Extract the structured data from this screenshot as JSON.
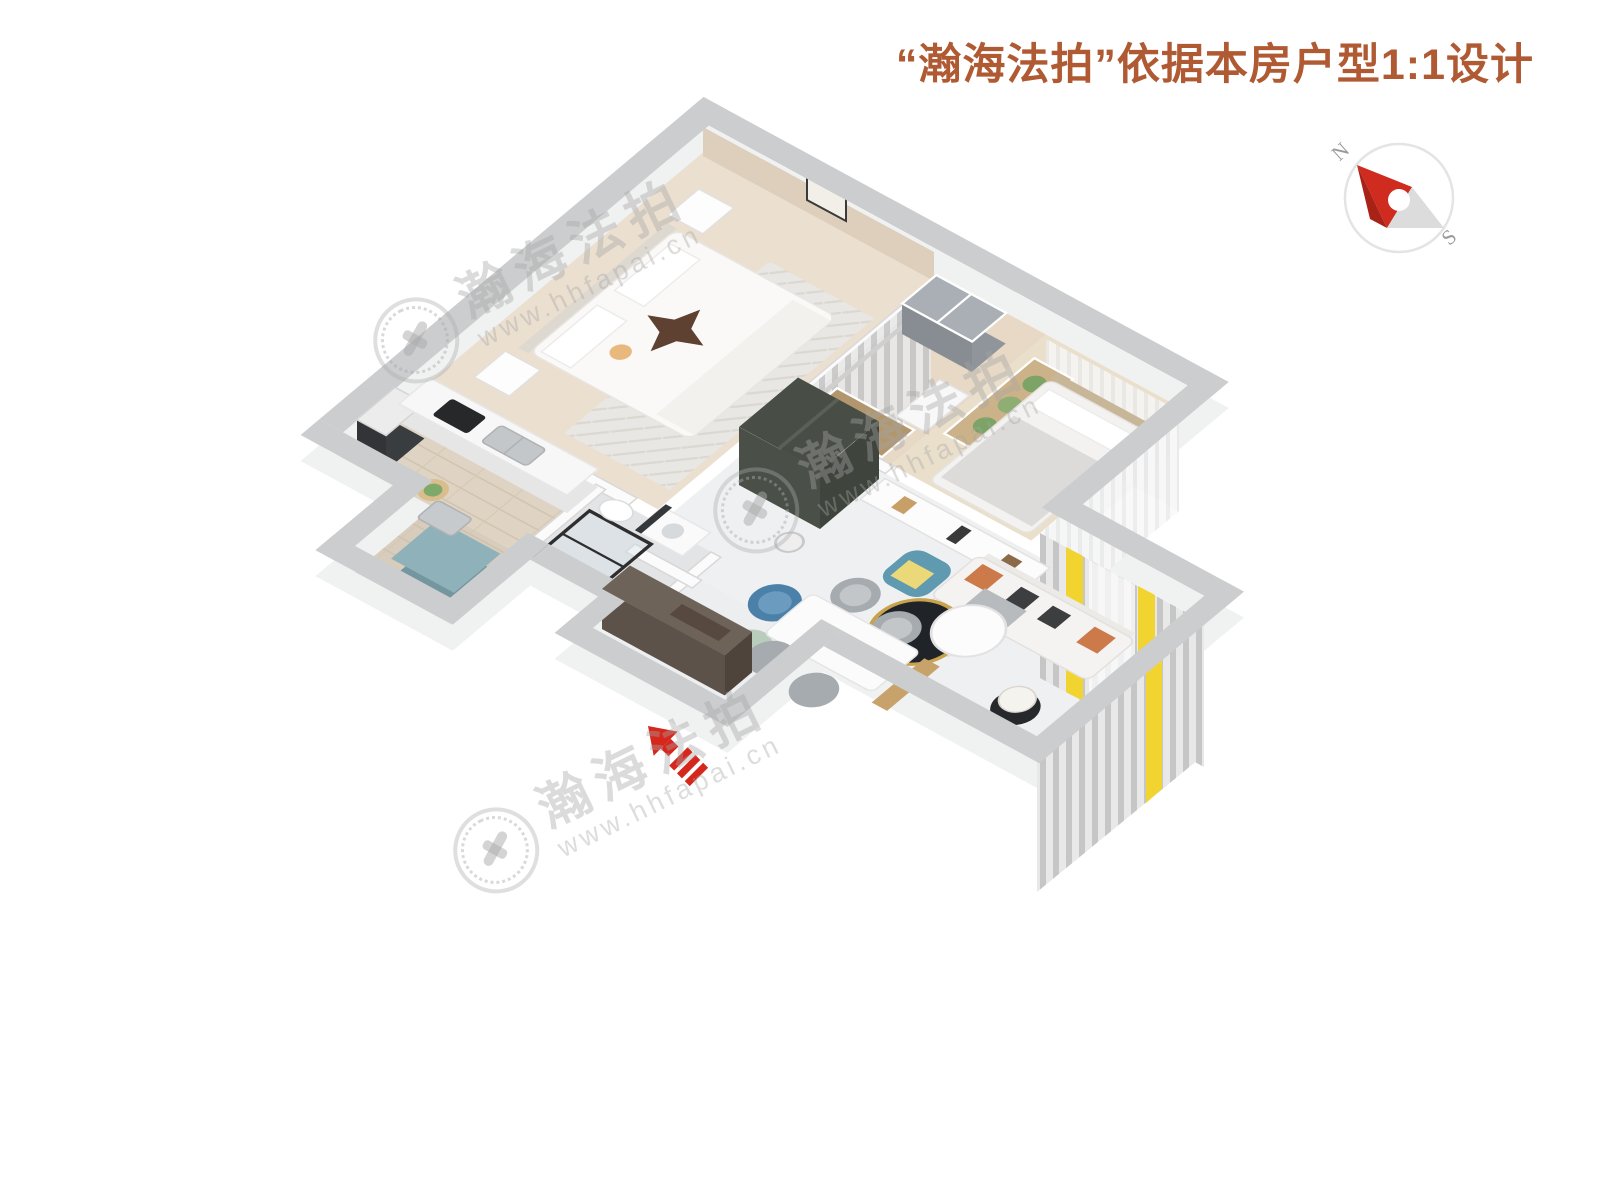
{
  "header": {
    "title": "“瀚海法拍”依据本房户型1:1设计",
    "color": "#b05a33"
  },
  "compass": {
    "north": "N",
    "south": "S",
    "needle_red": "#cf2b1e",
    "needle_dark_red": "#a92218",
    "needle_gray": "#dcdcdc",
    "ring_color": "#e4e4e4",
    "label_color": "#9a9a9a"
  },
  "watermark": {
    "brand": "瀚海法拍",
    "url": "www.hhfapai.cn"
  },
  "entrance_arrow": {
    "color": "#d6271c"
  },
  "rooms": [
    {
      "id": "master-bedroom"
    },
    {
      "id": "closet-dressing"
    },
    {
      "id": "second-bedroom"
    },
    {
      "id": "living-dining-room"
    },
    {
      "id": "kitchen"
    },
    {
      "id": "bathroom"
    },
    {
      "id": "laundry-balcony"
    },
    {
      "id": "entrance-hall"
    }
  ],
  "palette": {
    "wall_top": "#cbcdce",
    "wall_face": "#f0f1f1",
    "floor_marble": "#eff0f2",
    "floor_bedroom_beige": "#ebdfd0",
    "floor_wood": "#dfd4c3",
    "bedroom_accent_wall": "#decfbc",
    "curtain_gray": "#c9c9c9",
    "curtain_yellow": "#f2d431",
    "sofa_white": "#f4f3f1",
    "pillow_orange": "#cd7a4a",
    "armchair_teal": "#5f9ab0",
    "wardrobe_olive": "#575c54",
    "shoe_cabinet_brown": "#6e6358",
    "laundry_teal": "#8fb2ba",
    "blanket_star_brown": "#5e4130"
  }
}
